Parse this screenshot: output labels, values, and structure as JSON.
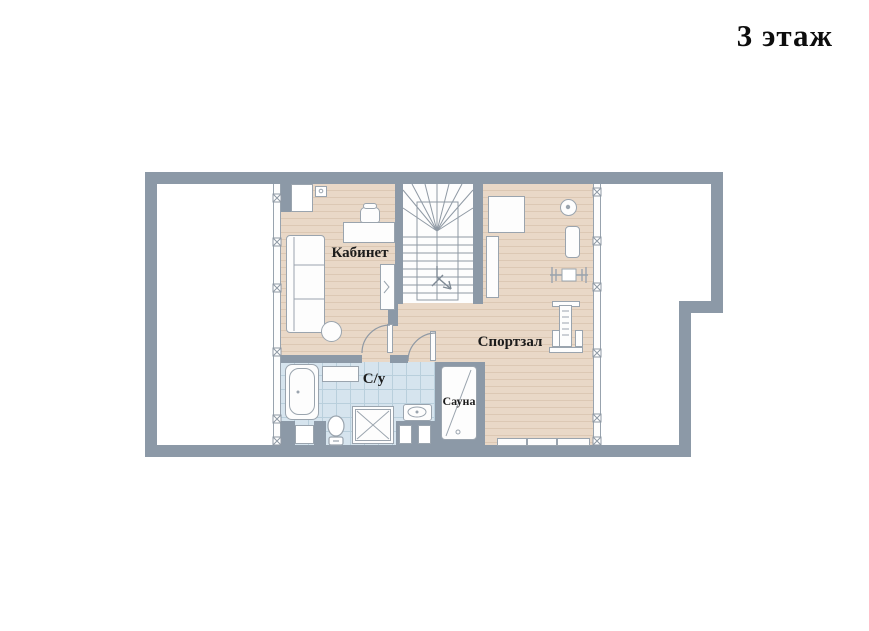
{
  "title": "3 этаж",
  "rooms": {
    "office": {
      "label": "Кабинет"
    },
    "gym": {
      "label": "Спортзал"
    },
    "bathroom": {
      "label": "С/у"
    },
    "sauna": {
      "label": "Сауна"
    }
  },
  "icons": [
    "staircase-winder-icon",
    "direction-arrow-icon",
    "door-swing-icon",
    "window-mullion-icon",
    "sofa-icon",
    "desk-icon",
    "office-chair-icon",
    "round-table-icon",
    "bookshelf-icon",
    "bathtub-icon",
    "toilet-icon",
    "shower-icon",
    "sink-icon",
    "sauna-cabin-icon",
    "exercise-mat-icon",
    "gym-ball-icon",
    "gym-bench-icon",
    "barbell-icon",
    "weight-machine-icon"
  ],
  "colors": {
    "wall": "#8c99a7",
    "wood_floor": "#e9d8c7",
    "wood_plank_line": "#dcc8b4",
    "tile_floor": "#d6e4ee",
    "tile_grid": "#b9cfdc",
    "fixture_outline": "#9aa4ae",
    "text": "#1c1c1c",
    "background": "#ffffff"
  }
}
